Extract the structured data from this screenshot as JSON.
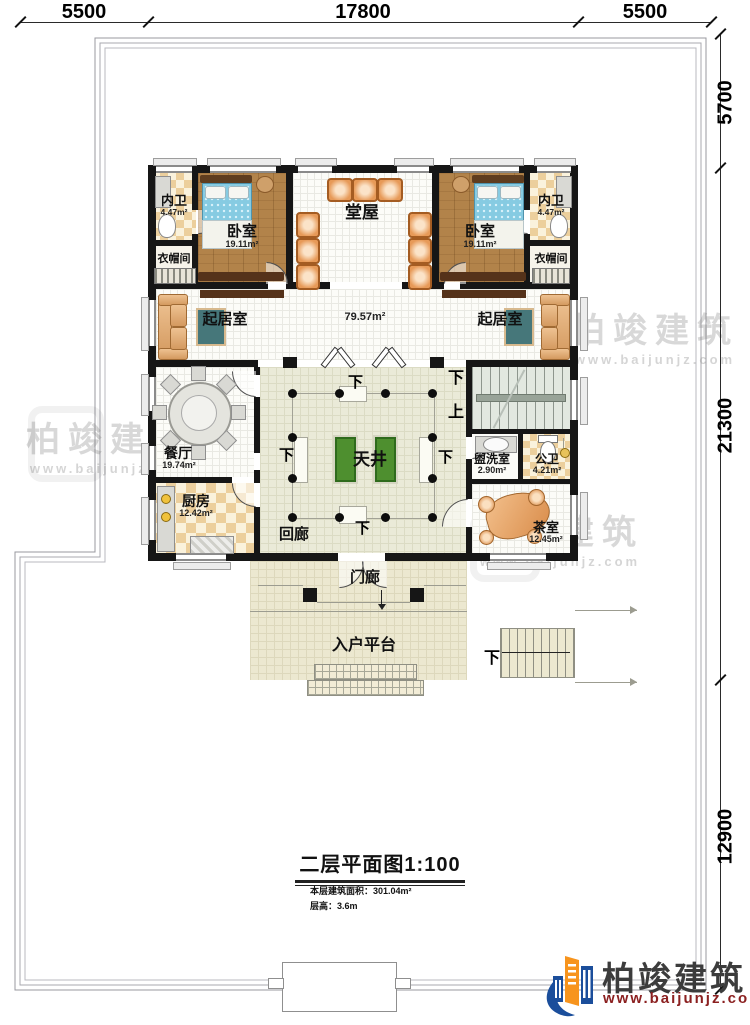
{
  "dimensions": {
    "top": [
      {
        "label": "5500"
      },
      {
        "label": "17800"
      },
      {
        "label": "5500"
      }
    ],
    "right": [
      {
        "label": "5700"
      },
      {
        "label": "21300"
      },
      {
        "label": "12900"
      }
    ]
  },
  "rooms": {
    "bath_left": {
      "name": "内卫",
      "area": "4.47m²"
    },
    "bedroom_left": {
      "name": "卧室",
      "area": "19.11m²"
    },
    "cloakroom_left": {
      "name": "衣帽间"
    },
    "hall": {
      "name": "堂屋"
    },
    "bedroom_right": {
      "name": "卧室",
      "area": "19.11m²"
    },
    "bath_right": {
      "name": "内卫",
      "area": "4.47m²"
    },
    "cloakroom_right": {
      "name": "衣帽间"
    },
    "living_left": {
      "name": "起居室"
    },
    "living_right": {
      "name": "起居室"
    },
    "middle_area": {
      "area": "79.57m²"
    },
    "dining": {
      "name": "餐厅",
      "area": "19.74m²"
    },
    "kitchen": {
      "name": "厨房",
      "area": "12.42m²"
    },
    "courtyard": {
      "name": "天井"
    },
    "corridor": {
      "name": "回廊"
    },
    "washroom": {
      "name": "盥洗室",
      "area": "2.90m²"
    },
    "public_bath": {
      "name": "公卫",
      "area": "4.21m²"
    },
    "tea_room": {
      "name": "茶室",
      "area": "12.45m²"
    },
    "porch": {
      "name": "门廊"
    },
    "entry_platform": {
      "name": "入户平台"
    }
  },
  "stair_labels": {
    "down": "下",
    "up": "上"
  },
  "title_block": {
    "title": "二层平面图1:100",
    "area_note": "本层建筑面积：301.04m²",
    "height_note": "层高：3.6m"
  },
  "brand": {
    "name": "柏竣建筑",
    "url": "www.baijunjz.com"
  },
  "watermark": {
    "text": "柏竣建筑",
    "url": "www.baijunjz.com"
  },
  "colors": {
    "wall": "#161616",
    "brand_blue": "#1b4e9b",
    "brand_orange": "#f7941d",
    "brand_red": "#8b2020",
    "planter_green": "#4e8f2f"
  }
}
